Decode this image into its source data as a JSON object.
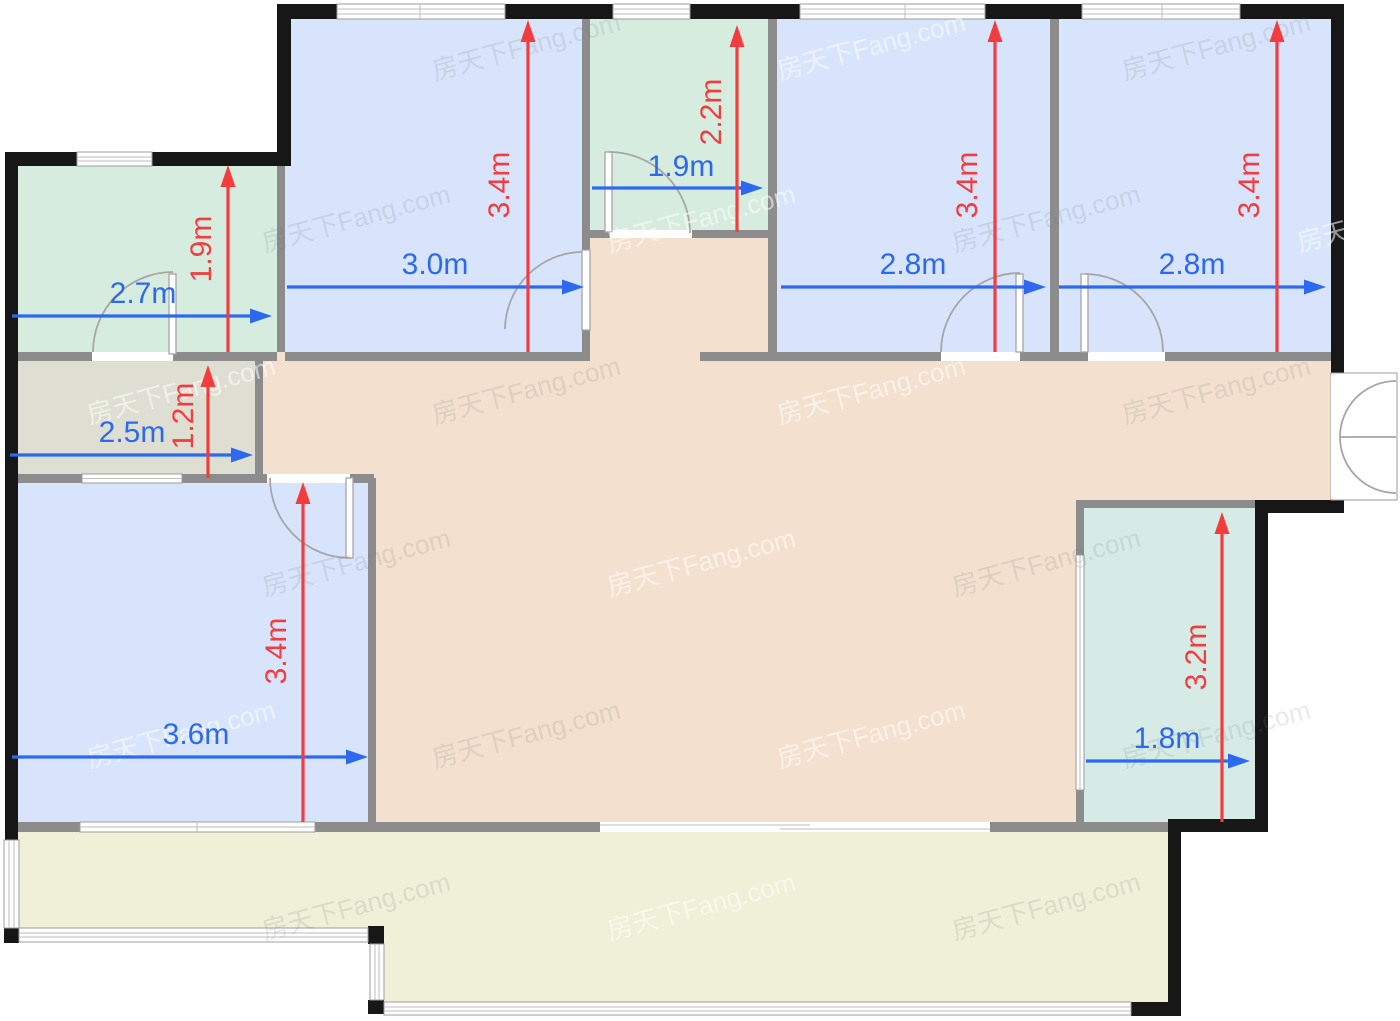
{
  "plan": {
    "unit": "m",
    "watermark_text": "房天下Fang.com"
  },
  "colors": {
    "room_blue": "#d7e4fc",
    "room_green": "#d6ecdf",
    "room_teal": "#d6ebe5",
    "room_gray": "#dedfd2",
    "living_tan": "#f3e0ce",
    "balcony_yellow": "#f0efd8",
    "wall_black": "#171717",
    "wall_gray": "#8c8c8c",
    "dim_blue": "#2d69f0",
    "dim_red": "#f23c3e"
  },
  "rooms": [
    {
      "id": "room-top-left",
      "width_label": "2.7m",
      "depth_label": "1.9m"
    },
    {
      "id": "room-top-mid",
      "width_label": "3.0m",
      "depth_label": "3.4m"
    },
    {
      "id": "room-top-center",
      "width_label": "1.9m",
      "depth_label": "2.2m"
    },
    {
      "id": "room-top-right-1",
      "width_label": "2.8m",
      "depth_label": "3.4m"
    },
    {
      "id": "room-top-right-2",
      "width_label": "2.8m",
      "depth_label": "3.4m"
    },
    {
      "id": "room-left-small",
      "width_label": "2.5m",
      "depth_label": "1.2m"
    },
    {
      "id": "room-bottom-left",
      "width_label": "3.6m",
      "depth_label": "3.4m"
    },
    {
      "id": "room-bottom-right",
      "width_label": "1.8m",
      "depth_label": "3.2m"
    }
  ]
}
